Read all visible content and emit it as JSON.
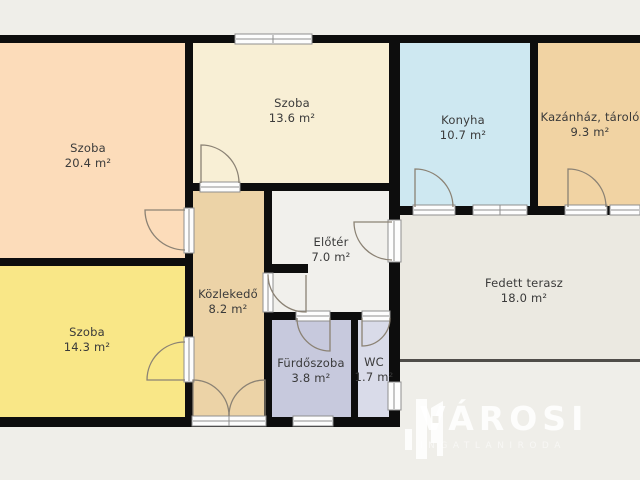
{
  "plan": {
    "background": "#efeee9",
    "wall_color": "#0d0d0d",
    "terrace_edge_color": "#4f4d49",
    "opening_fill": "#fdfdfd",
    "opening_stroke": "#8f8f8f",
    "door_arc_color": "#8b8274",
    "label_color": "#3a3a3a",
    "rooms": [
      {
        "id": "szoba-1",
        "label": "Szoba",
        "area": "20.4 m²",
        "color": "#fcdcba"
      },
      {
        "id": "szoba-2",
        "label": "Szoba",
        "area": "13.6 m²",
        "color": "#f8efd5"
      },
      {
        "id": "konyha",
        "label": "Konyha",
        "area": "10.7 m²",
        "color": "#cee8f1"
      },
      {
        "id": "kazanhaz",
        "label": "Kazánház, tároló",
        "area": "9.3 m²",
        "color": "#f1d3a3"
      },
      {
        "id": "szoba-3",
        "label": "Szoba",
        "area": "14.3 m²",
        "color": "#f9e787"
      },
      {
        "id": "kozlekedo",
        "label": "Közlekedő",
        "area": "8.2 m²",
        "color": "#ecd3a7"
      },
      {
        "id": "eloter",
        "label": "Előtér",
        "area": "7.0 m²",
        "color": "#f1f0ec"
      },
      {
        "id": "furdoszoba",
        "label": "Fürdőszoba",
        "area": "3.8 m²",
        "color": "#c7c9dd"
      },
      {
        "id": "wc",
        "label": "WC",
        "area": "1.7 m²",
        "color": "#d9dbe9"
      },
      {
        "id": "terasz",
        "label": "Fedett terasz",
        "area": "18.0 m²",
        "color": "#ebe9e1"
      }
    ]
  },
  "logo": {
    "brand": "VÁROSI",
    "subtitle": "INGATLANIRODA"
  }
}
